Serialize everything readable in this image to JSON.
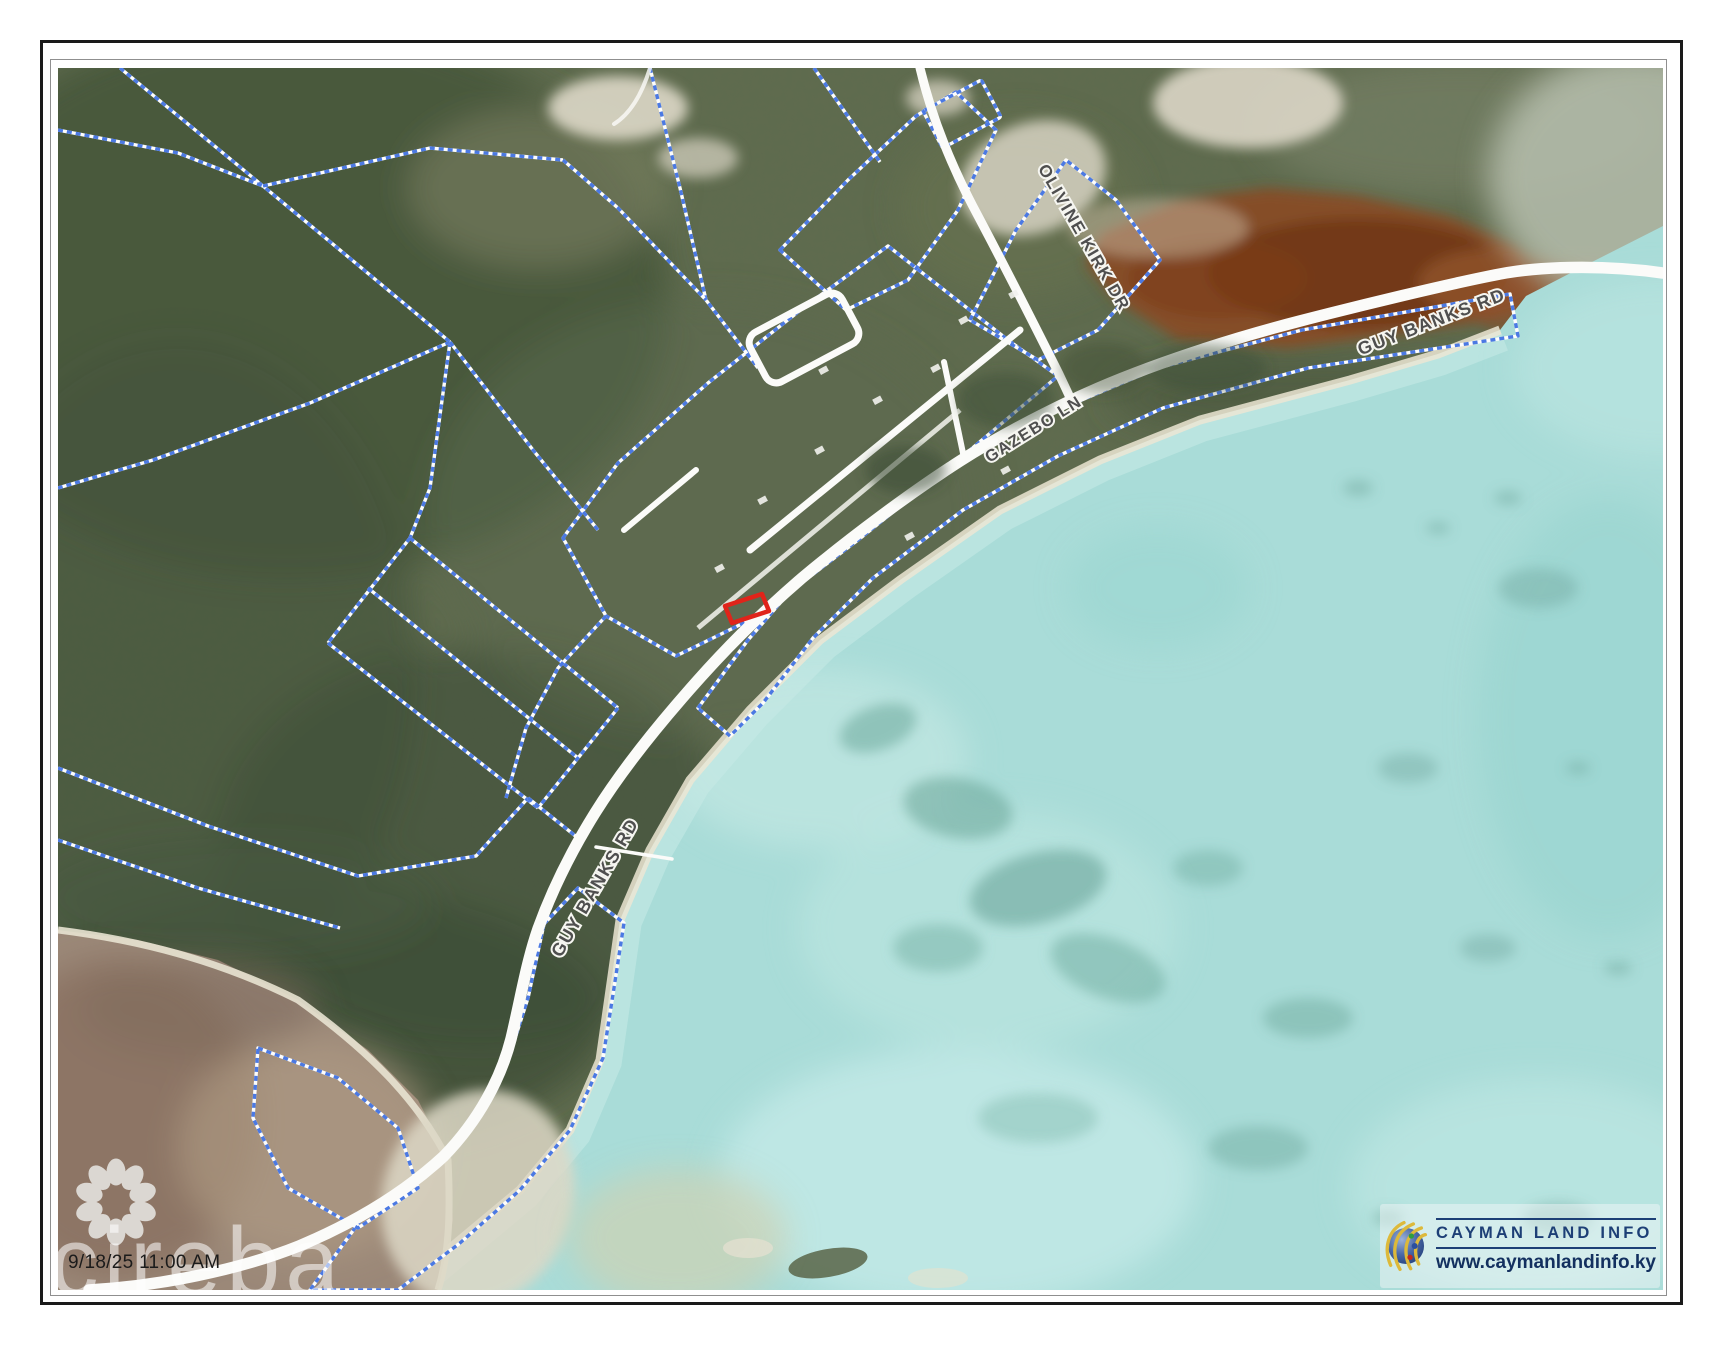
{
  "page": {
    "timestamp": "9/18/25 11:00 AM",
    "watermark_text": "cireba"
  },
  "map": {
    "road_labels": {
      "olivine_kirk": "OLIVINE KIRK DR",
      "guy_banks_ne": "GUY BANKS RD",
      "gazebo": "GAZEBO LN",
      "guy_banks_sw": "GUY BANKS RD"
    },
    "highlight_parcel_color": "#e0241a"
  },
  "logo": {
    "title": "CAYMAN LAND INFO",
    "website": "www.caymanlandinfo.ky"
  },
  "colors": {
    "parcel_line": "#4b79e3",
    "parcel_case": "#fdfdfd",
    "road": "#fbfbf9",
    "water": "#a9dcd8",
    "land": "#606b4f",
    "logo_navy": "#1d3f76"
  }
}
